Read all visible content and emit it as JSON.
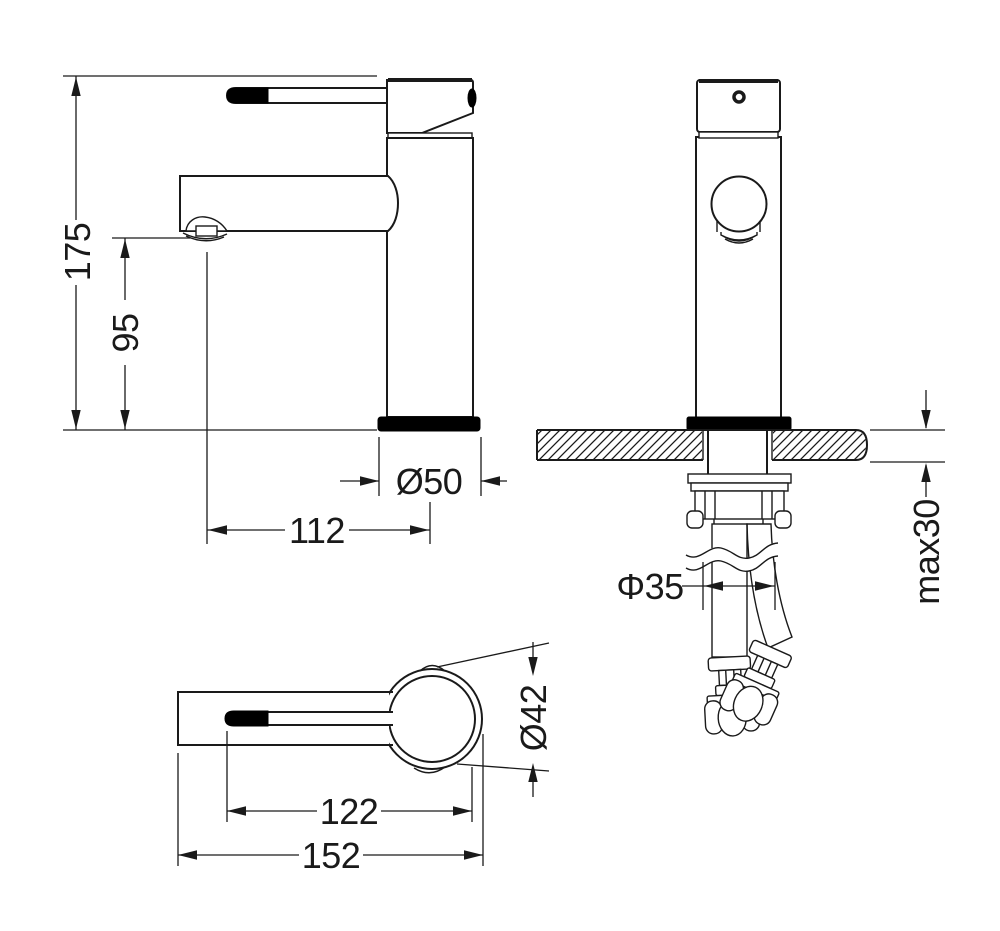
{
  "page": {
    "background": "#ffffff",
    "line_color": "#1a1a1a",
    "fill_color": "#000000"
  },
  "views": {
    "side": {
      "label": "side-view",
      "dims": {
        "total_height": "175",
        "spout_height": "95",
        "base_diameter": "Ø50",
        "spout_reach": "112"
      }
    },
    "front": {
      "label": "front-view",
      "dims": {
        "mounting_hole_diameter": "Φ35",
        "max_counter_thickness": "max30"
      }
    },
    "top": {
      "label": "top-view",
      "dims": {
        "body_diameter": "Ø42",
        "handle_reach": "122",
        "total_length": "152"
      }
    }
  }
}
